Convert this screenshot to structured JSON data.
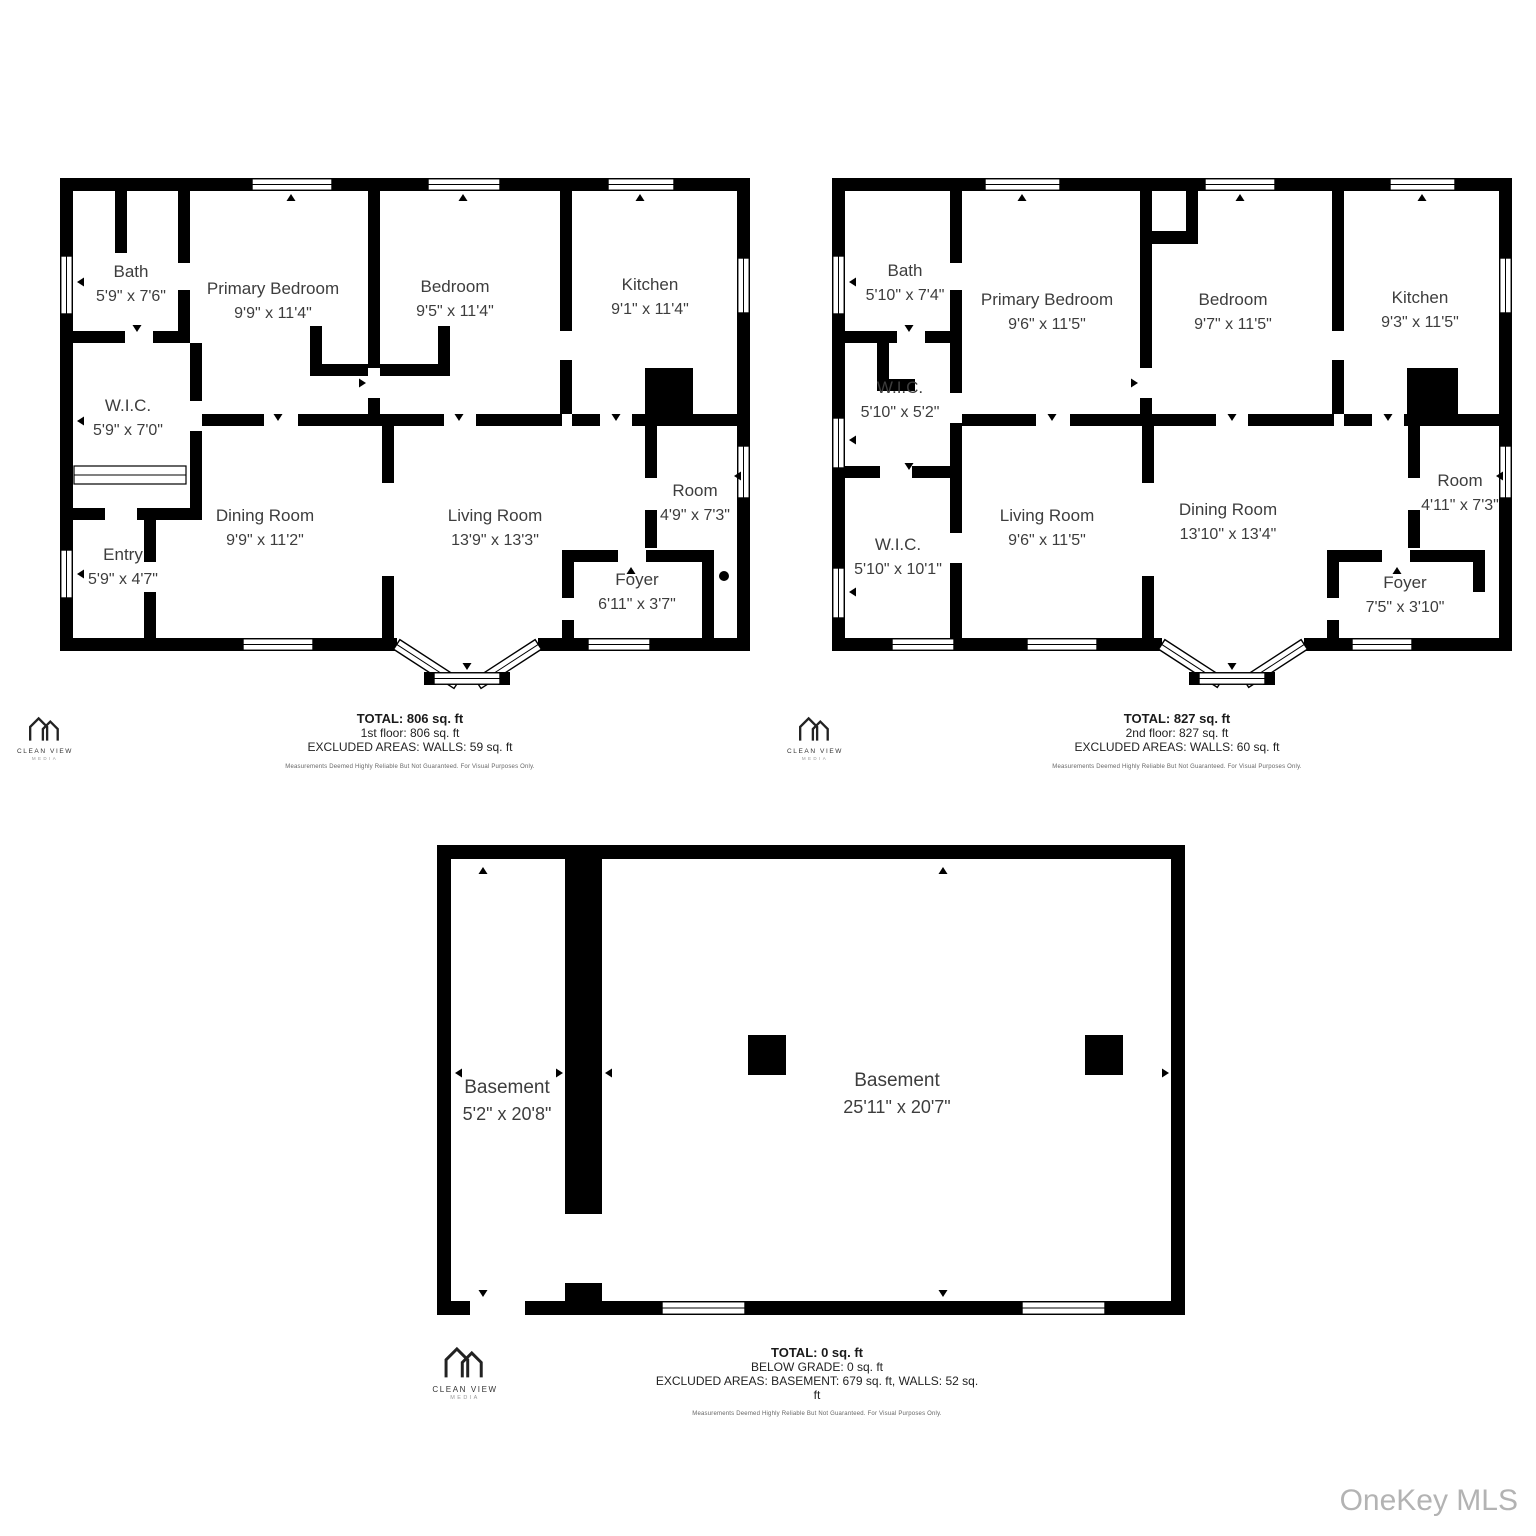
{
  "watermark": "OneKey MLS",
  "disclaimer": "Measurements Deemed Highly Reliable But Not Guaranteed. For Visual Purposes Only.",
  "logo": {
    "name": "CLEAN VIEW",
    "sub": "MEDIA"
  },
  "floor1": {
    "rooms": {
      "bath": {
        "name": "Bath",
        "dims": "5'9\" x 7'6\""
      },
      "wic": {
        "name": "W.I.C.",
        "dims": "5'9\" x 7'0\""
      },
      "entry": {
        "name": "Entry",
        "dims": "5'9\" x 4'7\""
      },
      "primary": {
        "name": "Primary Bedroom",
        "dims": "9'9\" x 11'4\""
      },
      "bedroom": {
        "name": "Bedroom",
        "dims": "9'5\" x 11'4\""
      },
      "kitchen": {
        "name": "Kitchen",
        "dims": "9'1\" x 11'4\""
      },
      "dining": {
        "name": "Dining Room",
        "dims": "9'9\" x 11'2\""
      },
      "living": {
        "name": "Living Room",
        "dims": "13'9\" x 13'3\""
      },
      "room": {
        "name": "Room",
        "dims": "4'9\" x 7'3\""
      },
      "foyer": {
        "name": "Foyer",
        "dims": "6'11\" x 3'7\""
      }
    },
    "summary": {
      "total": "TOTAL: 806 sq. ft",
      "floor": "1st floor: 806 sq. ft",
      "excluded": "EXCLUDED AREAS: WALLS: 59 sq. ft"
    }
  },
  "floor2": {
    "rooms": {
      "bath": {
        "name": "Bath",
        "dims": "5'10\" x 7'4\""
      },
      "wic1": {
        "name": "W.I.C.",
        "dims": "5'10\" x 5'2\""
      },
      "wic2": {
        "name": "W.I.C.",
        "dims": "5'10\" x 10'1\""
      },
      "primary": {
        "name": "Primary Bedroom",
        "dims": "9'6\" x 11'5\""
      },
      "bedroom": {
        "name": "Bedroom",
        "dims": "9'7\" x 11'5\""
      },
      "kitchen": {
        "name": "Kitchen",
        "dims": "9'3\" x 11'5\""
      },
      "living": {
        "name": "Living Room",
        "dims": "9'6\" x 11'5\""
      },
      "dining": {
        "name": "Dining Room",
        "dims": "13'10\" x 13'4\""
      },
      "room": {
        "name": "Room",
        "dims": "4'11\" x 7'3\""
      },
      "foyer": {
        "name": "Foyer",
        "dims": "7'5\" x 3'10\""
      }
    },
    "summary": {
      "total": "TOTAL: 827 sq. ft",
      "floor": "2nd floor: 827 sq. ft",
      "excluded": "EXCLUDED AREAS: WALLS: 60 sq. ft"
    }
  },
  "basement": {
    "rooms": {
      "small": {
        "name": "Basement",
        "dims": "5'2\" x 20'8\""
      },
      "main": {
        "name": "Basement",
        "dims": "25'11\" x 20'7\""
      }
    },
    "summary": {
      "total": "TOTAL: 0 sq. ft",
      "floor": "BELOW GRADE: 0 sq. ft",
      "excluded": "EXCLUDED AREAS: BASEMENT: 679 sq. ft, WALLS: 52 sq. ft"
    }
  }
}
